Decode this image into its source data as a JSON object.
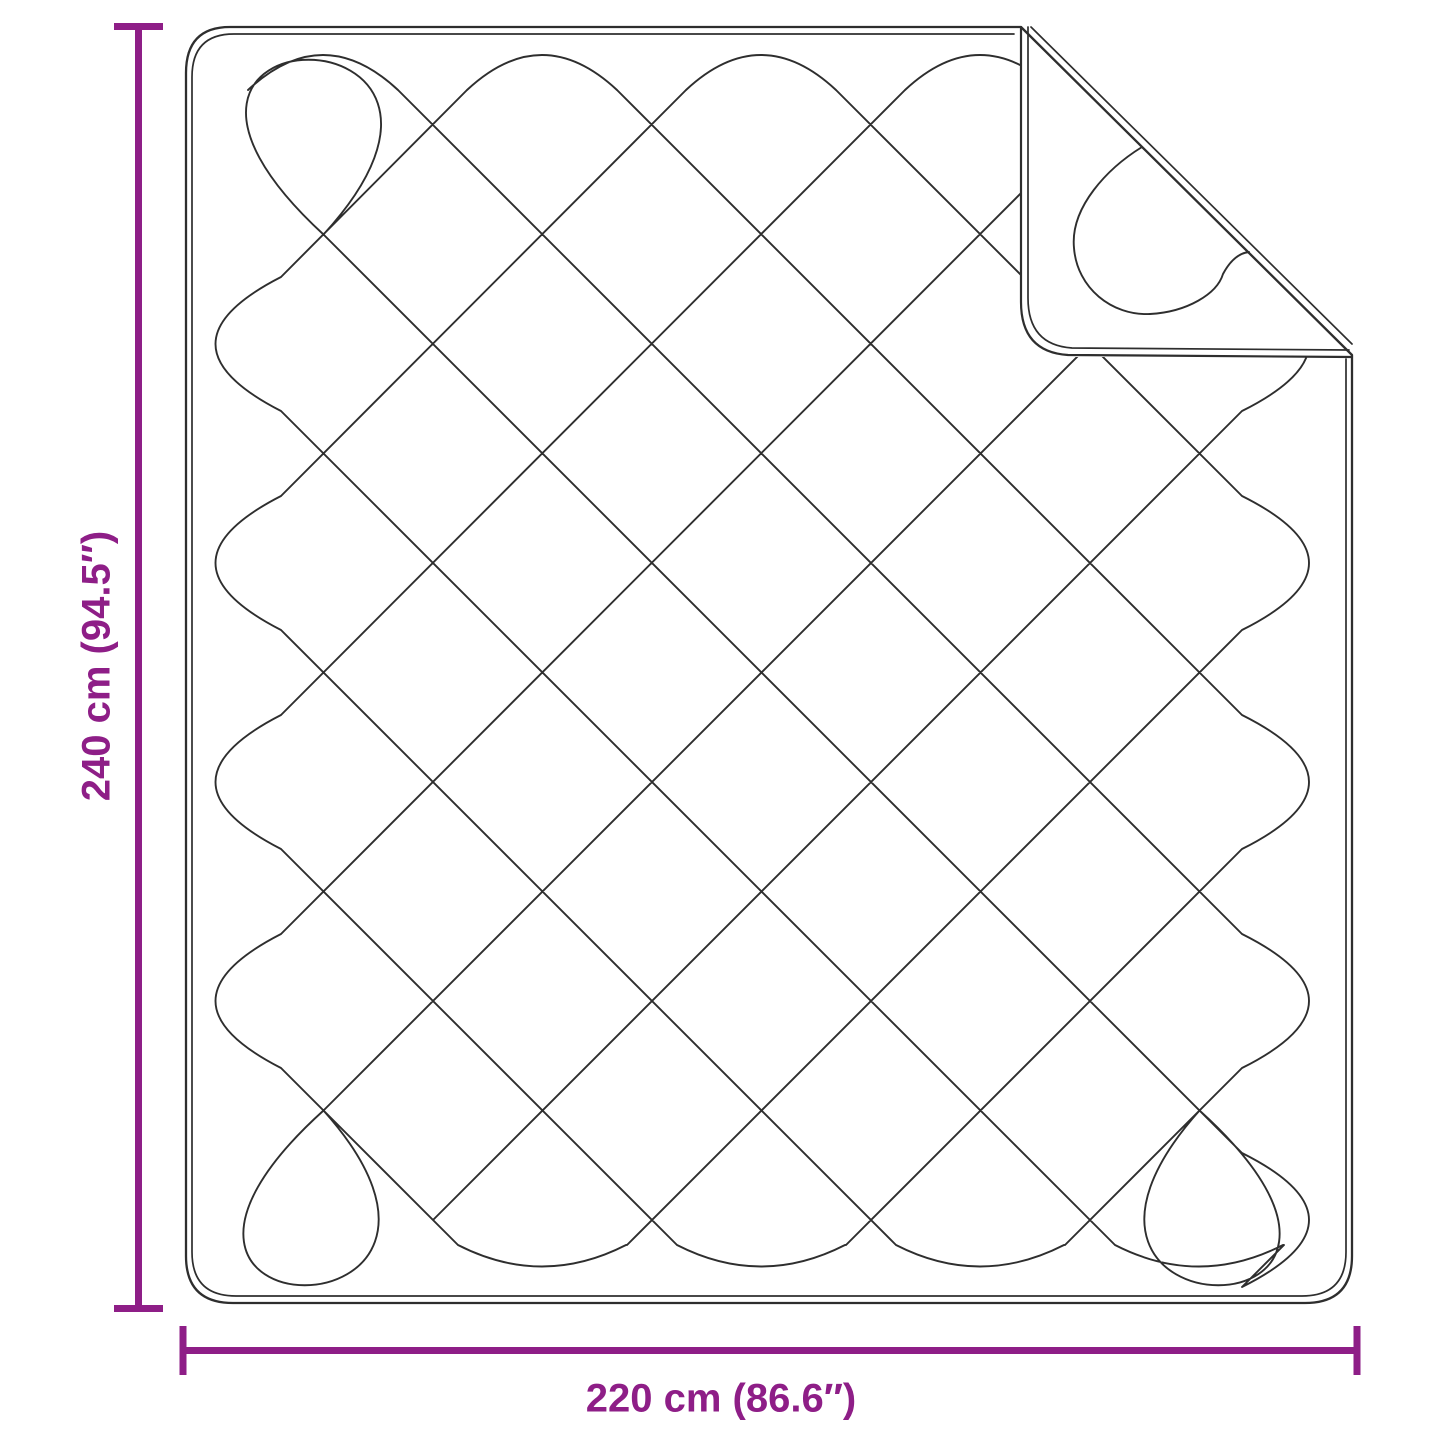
{
  "diagram": {
    "height_label": "240 cm (94.5″)",
    "width_label": "220 cm (86.6″)",
    "colors": {
      "accent": "#8E1E87",
      "line": "#2E2E2E",
      "background": "#FFFFFF"
    }
  }
}
